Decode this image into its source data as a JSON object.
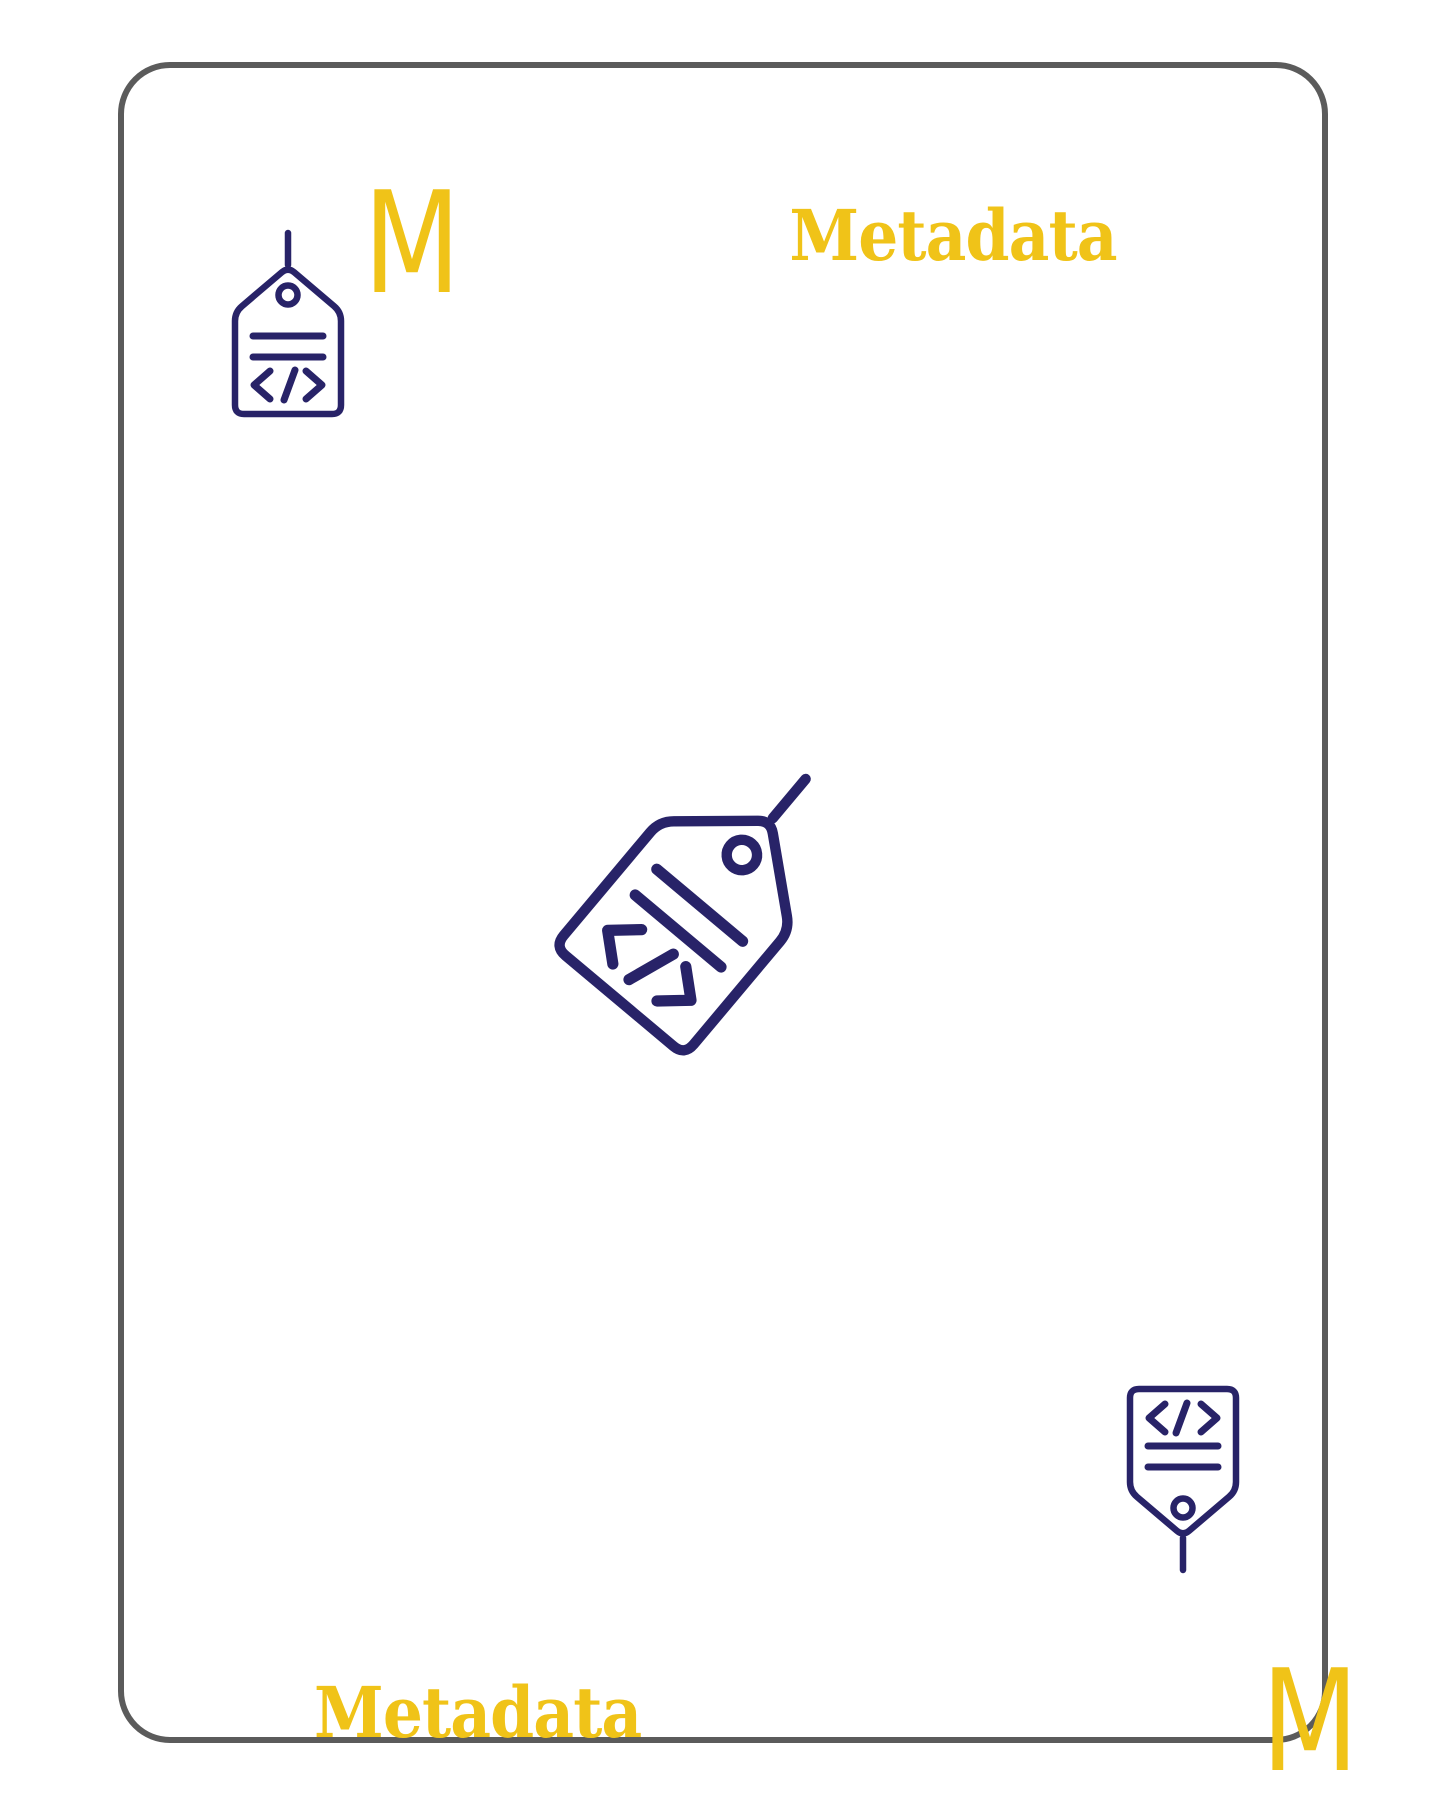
{
  "colors": {
    "accent_yellow": "#F0C318",
    "icon_navy": "#282368",
    "card_border_gray": "#5B5B5B"
  },
  "card": {
    "top_left": {
      "rank": "M",
      "icon": "metadata-tag-icon"
    },
    "top_right": {
      "label": "Metadata"
    },
    "center": {
      "icon": "metadata-tag-icon"
    },
    "bottom_left": {
      "label": "Metadata"
    },
    "bottom_right": {
      "rank": "M",
      "icon": "metadata-tag-icon"
    }
  }
}
